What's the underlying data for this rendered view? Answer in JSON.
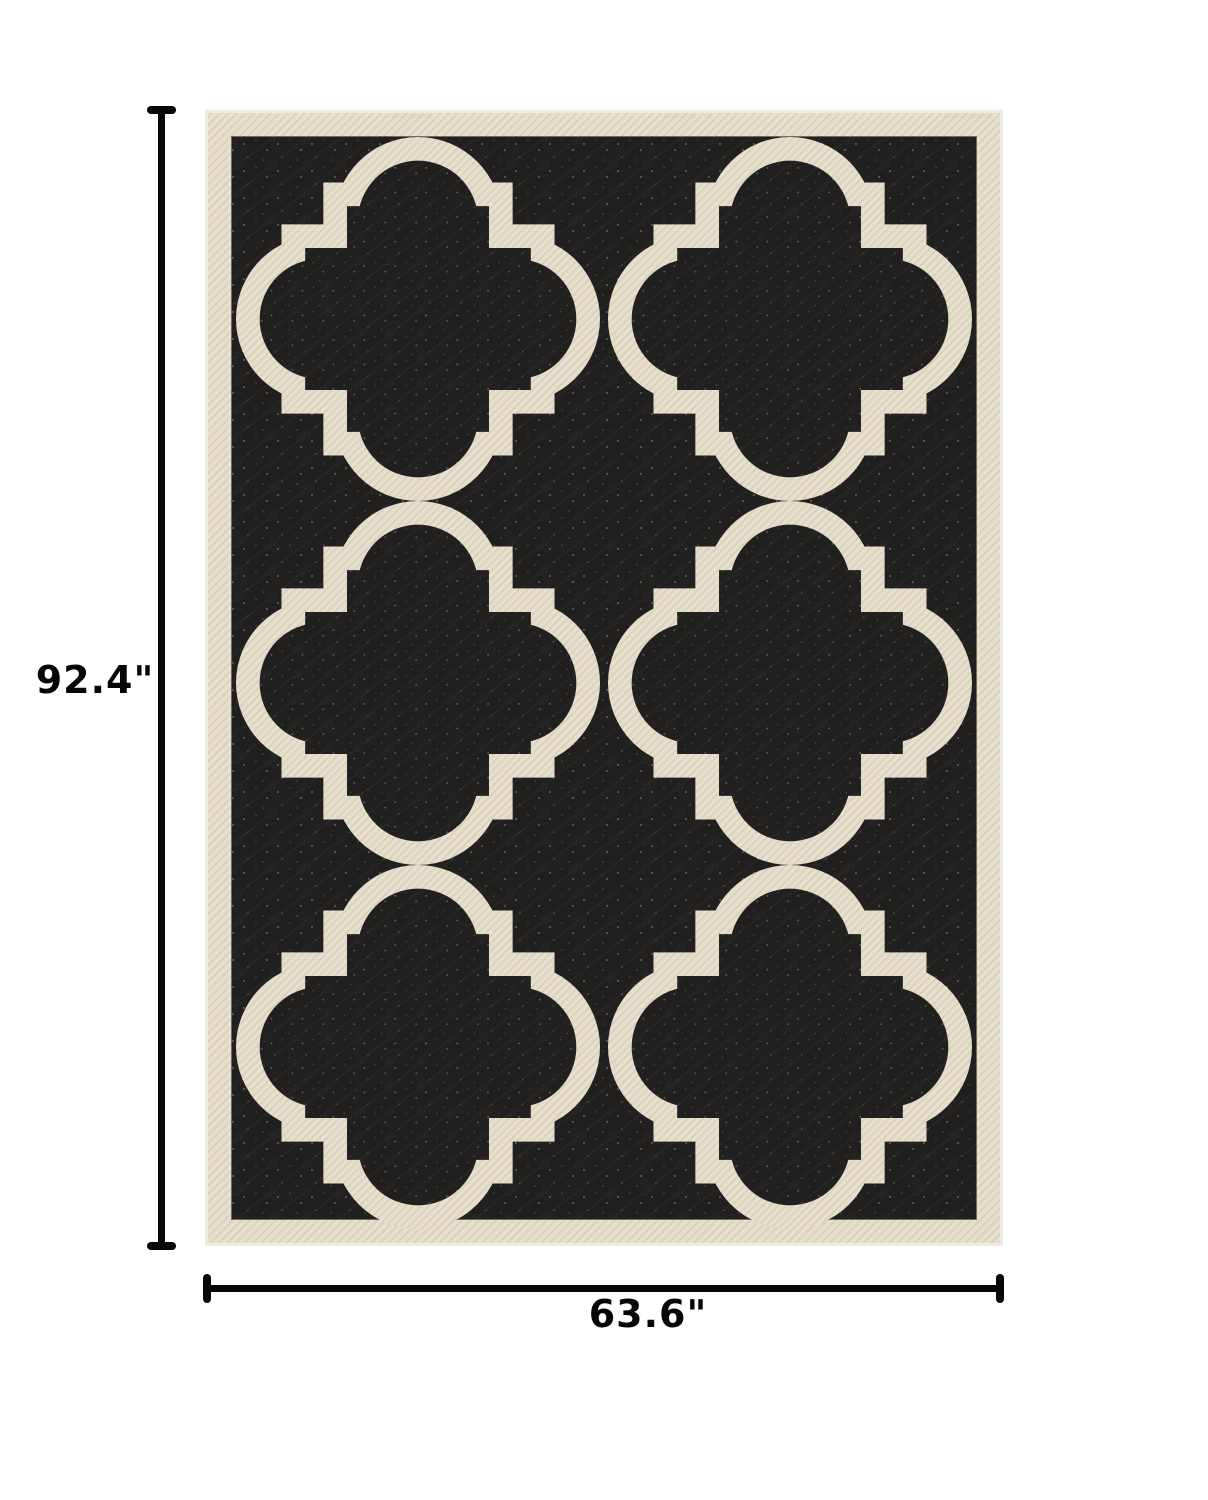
{
  "annotations": {
    "height_label": "92.4\"",
    "width_label": "63.6\""
  },
  "product": {
    "description": "Top-down photo of a rectangular area rug with quatrefoil trellis pattern",
    "pattern": "quatrefoil-trellis",
    "pattern_grid": {
      "rows": 3,
      "columns": 2
    },
    "colors": {
      "rug_field": "#21201e",
      "rug_motif_border": "#e7dfce",
      "weave_shadow": "#d5cab2",
      "page_background": "#ffffff",
      "dimension_lines": "#070707"
    }
  }
}
